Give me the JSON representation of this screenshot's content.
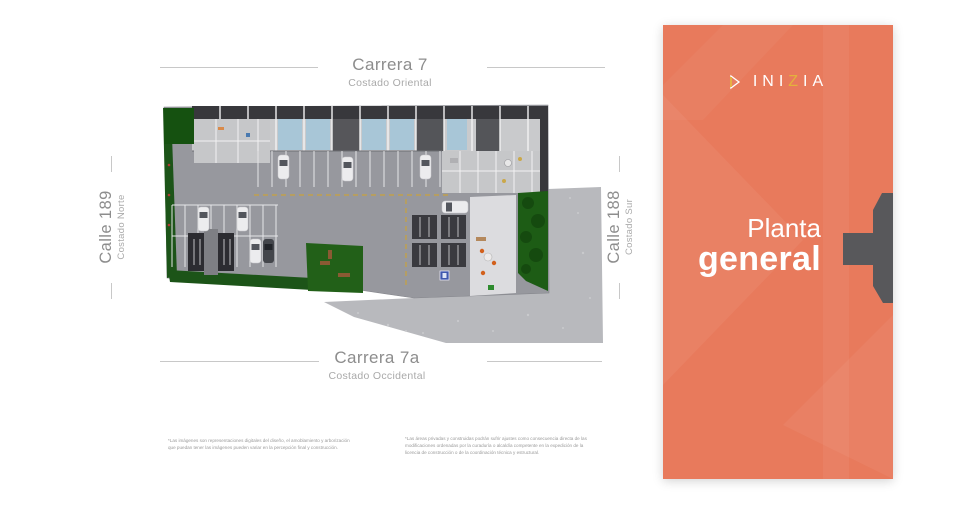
{
  "plan": {
    "streets": {
      "top": {
        "name": "Carrera 7",
        "side": "Costado Oriental"
      },
      "bottom": {
        "name": "Carrera 7a",
        "side": "Costado Occidental"
      },
      "left": {
        "name": "Calle 189",
        "side": "Costado Norte"
      },
      "right": {
        "name": "Calle 188",
        "side": "Costado Sur"
      }
    },
    "disclaimer_left": "*Las imágenes son representaciones digitales del diseño, el amoblamiento y arborización que puedan tener las imágenes pueden variar en la percepción final y construcción.",
    "disclaimer_right": "*Las áreas privadas y construidas podrán sufrir ajustes como consecuencia directa de las modificaciones ordenadas por la curaduría o alcaldía competente en la expedición de la licencia de construcción o de la coordinación técnica y estructural."
  },
  "brand": {
    "name_start": "INI",
    "name_accent": "Z",
    "name_end": "IA"
  },
  "panel": {
    "title_line1": "Planta",
    "title_line2": "general"
  },
  "colors": {
    "panel_orange": "#e87a5c",
    "brand_accent": "#e4b13c",
    "tab_gray": "#58585b",
    "label_gray": "#8d8d8d"
  }
}
